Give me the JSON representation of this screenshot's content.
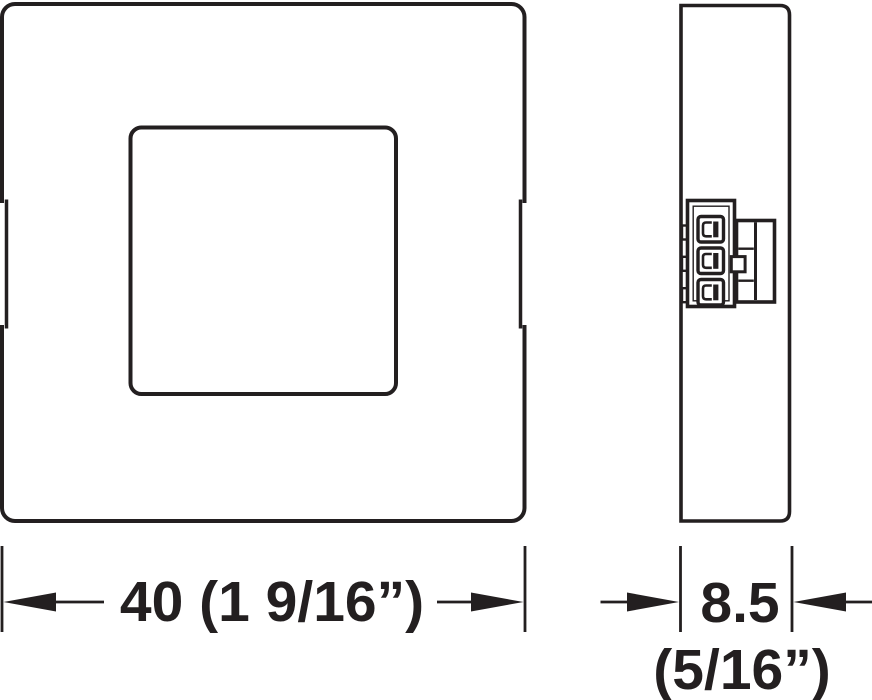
{
  "diagram": {
    "background_color": "#ffffff",
    "line_color": "#231f20",
    "dimension_width": {
      "label": "40 (1 9/16”)"
    },
    "dimension_depth": {
      "label": "8.5",
      "secondary_label": "(5/16”)"
    }
  }
}
